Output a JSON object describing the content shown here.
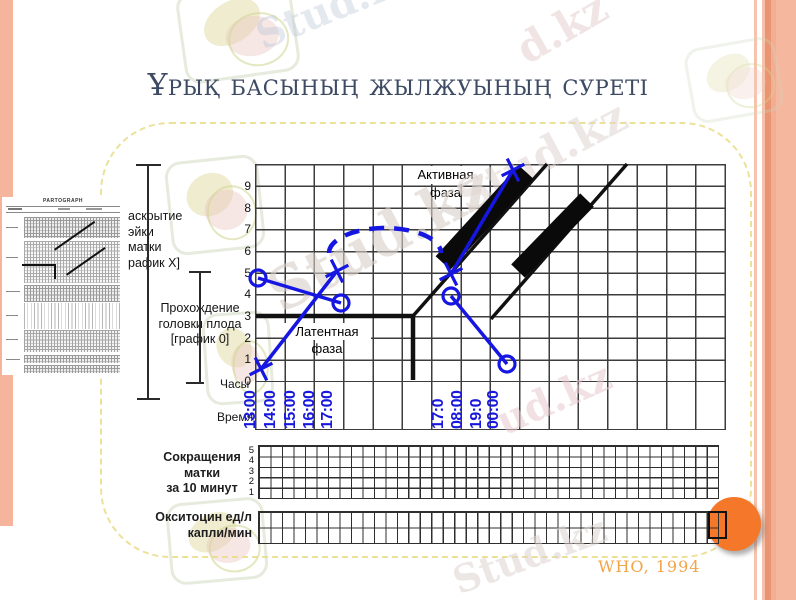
{
  "slide": {
    "title": "Ұрық басының жылжуының суреті",
    "citation": "WHO, 1994"
  },
  "watermark": {
    "brand": "Stud.kz",
    "frag_d": "d.kz",
    "frag_ud": "ud.kz"
  },
  "thumbnail": {
    "title": "PARTOGRAPH"
  },
  "labels": {
    "dilation": [
      "аскрытие",
      "эйки матки",
      "рафик X]"
    ],
    "descent": [
      "Прохождение",
      "головки плода",
      "[график 0]"
    ],
    "hours": "Часы",
    "time": "Время",
    "active_phase": "Активная фаза",
    "latent_phase": "Латентная фаза",
    "contractions": [
      "Сокращения",
      "матки",
      "за 10 минут"
    ],
    "contraction_scale": [
      "5",
      "4",
      "3",
      "2",
      "1"
    ],
    "oxytocin": [
      "Окситоцин ед/л",
      "капли/мин"
    ]
  },
  "axes": {
    "y": [
      "9",
      "8",
      "7",
      "6",
      "5",
      "4",
      "3",
      "2",
      "1",
      "0"
    ],
    "time": [
      "13:00",
      "14:00",
      "15:00",
      "16:00",
      "17:00",
      "17:0",
      "08:00",
      "19:0",
      "00:00"
    ]
  },
  "colors": {
    "title": "#3d4a63",
    "plot_blue": "#1616e2",
    "accent_orange": "#f4772a",
    "caption_orange": "#f2a449",
    "edge_salmon": "#f5b49c",
    "frame_yellow": "#e8dc87"
  },
  "chart_data": {
    "type": "line",
    "title": "Партограмма — раскрытие шейки матки (X) и прохождение головки плода (O) во времени",
    "xlabel": "Время (часы)",
    "ylabel": "см / уровень (0–10)",
    "x_tick_labels": [
      "13:00",
      "14:00",
      "15:00",
      "16:00",
      "17:00",
      "17:0",
      "08:00",
      "19:0",
      "00:00"
    ],
    "y_tick_labels": [
      9,
      8,
      7,
      6,
      5,
      4,
      3,
      2,
      1,
      0
    ],
    "ylim": [
      0,
      10
    ],
    "grid": {
      "columns": 16,
      "rows": 10,
      "grid_on": true
    },
    "phase_labels": [
      "Активная фаза",
      "Латентная фаза"
    ],
    "series": [
      {
        "name": "Раскрытие шейки матки [график X]",
        "marker": "X",
        "segments": [
          [
            {
              "t": "13:00",
              "v": 1
            },
            {
              "t": "15:45",
              "v": 5
            }
          ],
          [
            {
              "t": "19:40",
              "v": 5
            },
            {
              "t": "21:45",
              "v": 10
            }
          ]
        ]
      },
      {
        "name": "Прохождение головки плода [график 0]",
        "marker": "O",
        "segments": [
          [
            {
              "t": "13:00",
              "v": 5
            },
            {
              "t": "15:50",
              "v": 4
            }
          ],
          [
            {
              "t": "19:40",
              "v": 4
            },
            {
              "t": "21:30",
              "v": 1
            }
          ]
        ]
      }
    ],
    "reference_lines": [
      {
        "name": "линия бдительности (alert line)",
        "from_v": 3,
        "to_v": 10
      },
      {
        "name": "линия действия (action line)",
        "offset": "параллельно, правее"
      }
    ],
    "annotations": [
      "дуга ожидаемого течения (пунктир)",
      "два чёрных бруска вдоль линий"
    ]
  }
}
